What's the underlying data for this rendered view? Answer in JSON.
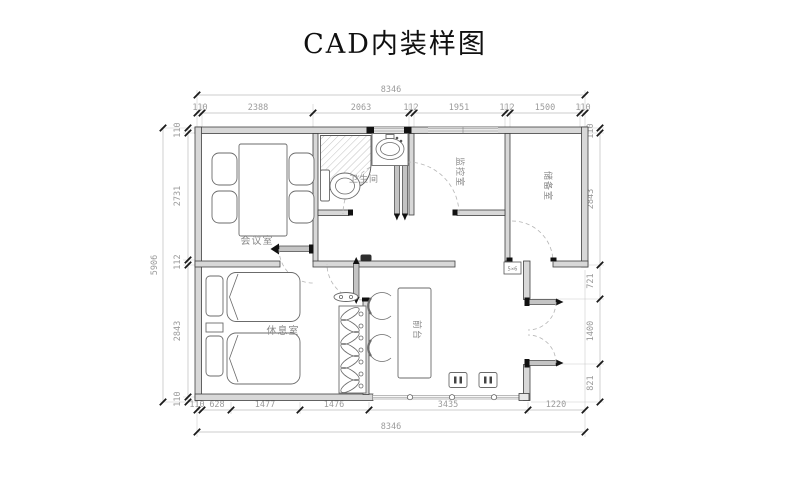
{
  "title": "CAD内装样图",
  "colors": {
    "wall_fill": "#d8d8d8",
    "wall_line": "#3f3f3f",
    "dim_text": "#9b9b9b",
    "dim_line": "#bcbcbc",
    "tick": "#1a1a1a",
    "furniture_line": "#6b6b6b",
    "door_arc": "#b5b5b5"
  },
  "rooms": {
    "meeting": {
      "label": "会议室"
    },
    "bathroom": {
      "label": "卫生间"
    },
    "monitoring": {
      "label": "监控室"
    },
    "storage": {
      "label": "储备室"
    },
    "rest": {
      "label": "休息室"
    },
    "reception_desk": {
      "label": "前台"
    }
  },
  "annotations": {
    "box_label": "5×6"
  },
  "dimensions": {
    "top_overall": "8346",
    "top_chain": [
      "110",
      "2388",
      "2063",
      "112",
      "1951",
      "112",
      "1500",
      "110"
    ],
    "bottom_chain": [
      "110",
      "628",
      "1477",
      "1476",
      "3435",
      "1220"
    ],
    "bottom_overall": "8346",
    "left_overall": "5906",
    "left_chain": [
      "110",
      "2731",
      "112",
      "2843",
      "110"
    ],
    "right_chain": [
      "110",
      "2843",
      "721",
      "1400",
      "821"
    ]
  }
}
